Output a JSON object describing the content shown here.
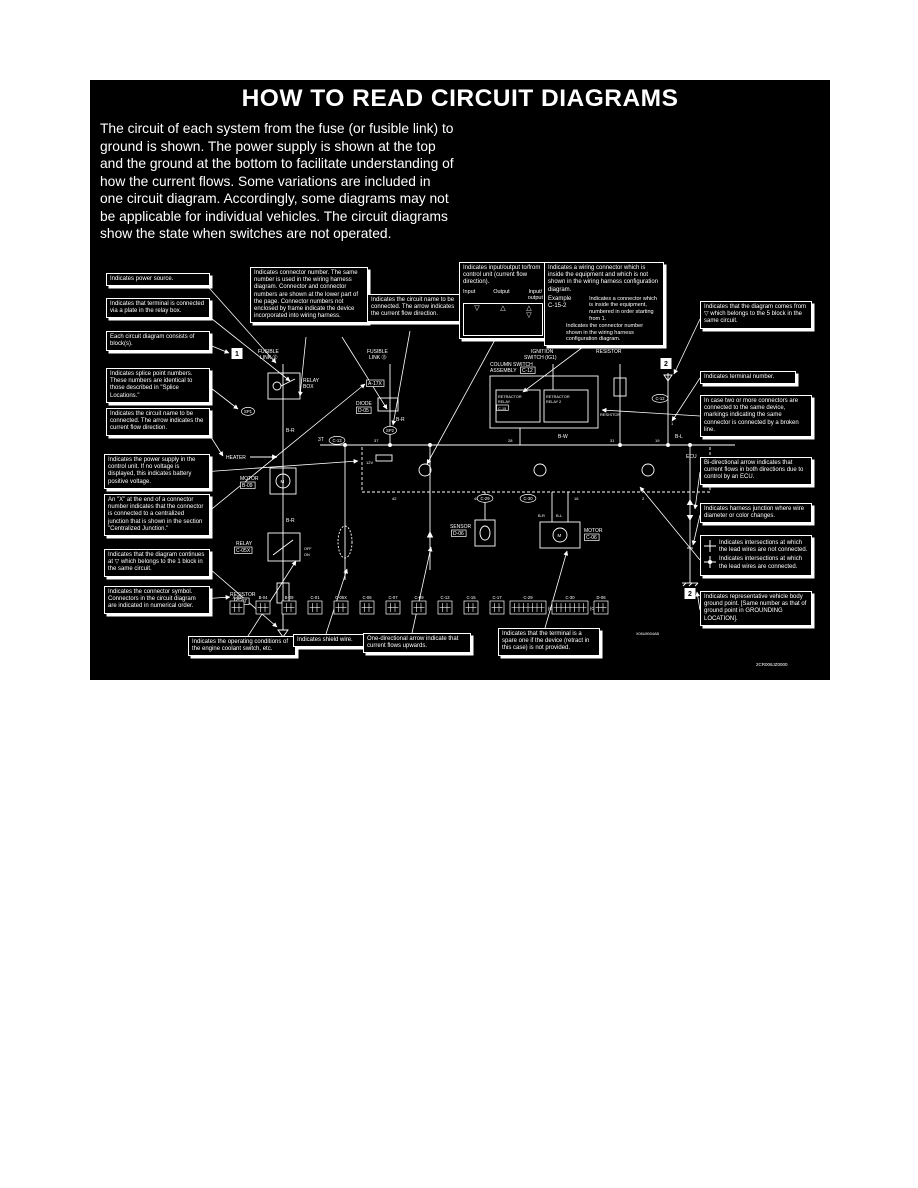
{
  "page": {
    "title": "HOW TO READ CIRCUIT DIAGRAMS"
  },
  "colors": {
    "background": "#ffffff",
    "panel": "#000000",
    "ink": "#ffffff"
  },
  "intro": {
    "text": "The circuit of each system from the fuse (or fusible link) to ground is shown. The power supply is shown at the top and the ground at the bottom to facilitate understanding of how the current flows. Some variations are included in one circuit diagram. Accordingly, some diagrams may not be applicable for individual vehicles. The circuit diagrams show the state when switches are not operated."
  },
  "callouts": {
    "left": [
      {
        "text": "Indicates power source."
      },
      {
        "text": "Indicates that terminal is connected via a plate in the relay box."
      },
      {
        "text": "Each circuit diagram consists of block(s)."
      },
      {
        "text": "Indicates splice point numbers. These numbers are identical to those described in \"Splice Locations.\""
      },
      {
        "text": "Indicates the circuit name to be connected. The arrow indicates the current flow direction."
      },
      {
        "text": "Indicates the power supply in the control unit. If no voltage is displayed, this indicates battery positive voltage."
      },
      {
        "text": "An \"X\" at the end of a connector number indicates that the connector is connected to a centralized junction that is shown in the section \"Centralized Junction.\""
      },
      {
        "text": "Indicates that the diagram continues at ▽ which belongs to the 1 block in the same circuit."
      },
      {
        "text": "Indicates the connector symbol. Connectors in the circuit diagram are indicated in numerical order."
      }
    ],
    "top": [
      {
        "text": "Indicates connector number. The same number is used in the wiring harness diagram. Connector and connector numbers are shown at the lower part of the page. Connector numbers not enclosed by frame indicate the device incorporated into wiring harness."
      },
      {
        "text": "Indicates the circuit name to be connected. The arrow indicates the current flow direction."
      }
    ],
    "io": {
      "caption": "Indicates input/output to/from control unit (current flow direction).",
      "input": "Input",
      "output": "Output",
      "io": "Input/\noutput",
      "input_symbol": "▽",
      "output_symbol": "△",
      "io_symbol": "△\n▽"
    },
    "wiring_connector": {
      "text": "Indicates a wiring connector which is inside the equipment and which is not shown in the wiring harness configuration diagram.",
      "example_label": "Example",
      "example_value": "C-15-2",
      "note_equipment": "Indicates a connector which is inside the equipment, numbered in order starting from 1.",
      "note_number": "Indicates the connector number shown in the wiring harness configuration diagram."
    },
    "right": [
      {
        "text": "Indicates that the diagram comes from ▽ which belongs to the 5 block in the same circuit."
      },
      {
        "text": "Indicates terminal number."
      },
      {
        "text": "In case two or more connectors are connected to the same device, markings indicating the same connector is connected by a broken line."
      },
      {
        "text": "Bi-directional arrow indicates that current flows in both directions due to control by an ECU."
      },
      {
        "text": "Indicates harness junction where wire diameter or color changes."
      },
      {
        "text": "Indicates representative vehicle body ground point. [Same number as that of ground point in GROUNDING LOCATION]."
      }
    ],
    "intersections": {
      "not_connected": "Indicates intersections at which the lead wires are not connected.",
      "connected": "Indicates intersections at which the lead wires are connected."
    },
    "bottom": [
      {
        "text": "Indicates the operating conditions of the engine coolant switch, etc."
      },
      {
        "text": "Indicates shield wire."
      },
      {
        "text": "One-directional arrow indicate that current flows upwards."
      },
      {
        "text": "Indicates that the terminal is a spare one if the device (retract in this case) is not provided."
      }
    ]
  },
  "diagram": {
    "codes": {
      "small": "X06U8004AB",
      "figure": "2CR006JZ0000"
    },
    "labels": [
      {
        "t": "FUSIBLE",
        "x": 168,
        "y": 273
      },
      {
        "t": "LINK ⑫",
        "x": 170,
        "y": 279
      },
      {
        "t": "FUSIBLE",
        "x": 277,
        "y": 273
      },
      {
        "t": "LINK ⑬",
        "x": 279,
        "y": 279
      },
      {
        "t": "IGNITION",
        "x": 441,
        "y": 273
      },
      {
        "t": "SWITCH (IG1)",
        "x": 434,
        "y": 279
      },
      {
        "t": "RESISTOR",
        "x": 506,
        "y": 273
      },
      {
        "t": "1",
        "x": 147,
        "y": 277,
        "wbox": true
      },
      {
        "t": "2",
        "x": 576,
        "y": 287,
        "wbox": true
      },
      {
        "t": "RELAY",
        "x": 213,
        "y": 302
      },
      {
        "t": "BOX",
        "x": 213,
        "y": 308
      },
      {
        "t": "SP1",
        "x": 158,
        "y": 333,
        "oval": true
      },
      {
        "t": "A-17X",
        "x": 278,
        "y": 305,
        "box": true
      },
      {
        "t": "DIODE",
        "x": 266,
        "y": 325
      },
      {
        "t": "D-05",
        "x": 268,
        "y": 332,
        "box": true
      },
      {
        "t": "B-R",
        "x": 196,
        "y": 352
      },
      {
        "t": "B-R",
        "x": 306,
        "y": 341
      },
      {
        "t": "B-R",
        "x": 196,
        "y": 442
      },
      {
        "t": "B-W",
        "x": 468,
        "y": 358
      },
      {
        "t": "B-L",
        "x": 585,
        "y": 358
      },
      {
        "t": "SP2",
        "x": 300,
        "y": 352,
        "oval": true
      },
      {
        "t": "HEATER",
        "x": 136,
        "y": 379
      },
      {
        "t": "MOTOR",
        "x": 150,
        "y": 400
      },
      {
        "t": "B-09",
        "x": 152,
        "y": 407,
        "box": true
      },
      {
        "t": "M",
        "x": 190.5,
        "y": 403,
        "s": 4.5
      },
      {
        "t": "COLUMN SWITCH",
        "x": 400,
        "y": 286
      },
      {
        "t": "ASSEMBLY",
        "x": 400,
        "y": 292
      },
      {
        "t": "C-12",
        "x": 432,
        "y": 292,
        "box": true
      },
      {
        "t": "RETRACTOR",
        "x": 408,
        "y": 318,
        "s": 3.8
      },
      {
        "t": "RELAY",
        "x": 408,
        "y": 323,
        "s": 3.8
      },
      {
        "t": "C-15",
        "x": 408,
        "y": 330,
        "s": 3.8,
        "box": true
      },
      {
        "t": "RETRACTOR",
        "x": 456,
        "y": 318,
        "s": 3.8
      },
      {
        "t": "RELAY 2",
        "x": 456,
        "y": 323,
        "s": 3.8
      },
      {
        "t": "RESISTOR",
        "x": 510,
        "y": 336,
        "s": 4
      },
      {
        "t": "C-12",
        "x": 570,
        "y": 320,
        "oval": true
      },
      {
        "t": "1",
        "x": 581,
        "y": 345,
        "s": 4
      },
      {
        "t": "3T",
        "x": 228,
        "y": 361
      },
      {
        "t": "C-13",
        "x": 247,
        "y": 362,
        "oval": true
      },
      {
        "t": "37",
        "x": 284,
        "y": 362,
        "s": 4
      },
      {
        "t": "28",
        "x": 418,
        "y": 362,
        "s": 4
      },
      {
        "t": "31",
        "x": 520,
        "y": 362,
        "s": 4
      },
      {
        "t": "19",
        "x": 565,
        "y": 362,
        "s": 4
      },
      {
        "t": "ECU",
        "x": 596,
        "y": 378
      },
      {
        "t": "12V",
        "x": 276,
        "y": 384,
        "s": 4
      },
      {
        "t": "42",
        "x": 302,
        "y": 420,
        "s": 4
      },
      {
        "t": "49",
        "x": 384,
        "y": 420,
        "s": 4
      },
      {
        "t": "16",
        "x": 484,
        "y": 420,
        "s": 4
      },
      {
        "t": "2",
        "x": 552,
        "y": 420,
        "s": 4
      },
      {
        "t": "C-29",
        "x": 395,
        "y": 420,
        "oval": true
      },
      {
        "t": "C-30",
        "x": 438,
        "y": 420,
        "oval": true
      },
      {
        "t": "SENSOR",
        "x": 360,
        "y": 448
      },
      {
        "t": "D-06",
        "x": 363,
        "y": 455,
        "box": true
      },
      {
        "t": "MOTOR",
        "x": 494,
        "y": 452
      },
      {
        "t": "C-06",
        "x": 496,
        "y": 459,
        "box": true
      },
      {
        "t": "M",
        "x": 467.5,
        "y": 457,
        "s": 4.5
      },
      {
        "t": "B-R",
        "x": 448,
        "y": 437,
        "s": 4
      },
      {
        "t": "B-L",
        "x": 466,
        "y": 437,
        "s": 4
      },
      {
        "t": "RELAY",
        "x": 146,
        "y": 465
      },
      {
        "t": "C-05X",
        "x": 146,
        "y": 472,
        "box": true
      },
      {
        "t": "OFF",
        "x": 214,
        "y": 470,
        "s": 3.8
      },
      {
        "t": "ON",
        "x": 214,
        "y": 476,
        "s": 3.8
      },
      {
        "t": "RESISTOR",
        "x": 140,
        "y": 516
      },
      {
        "t": "C-07",
        "x": 146,
        "y": 523,
        "box": true
      },
      {
        "t": "2",
        "x": 600,
        "y": 517,
        "wbox": true
      },
      {
        "t": "X06U8004AB",
        "x": 546,
        "y": 555,
        "s": 3.8
      },
      {
        "t": "2CR006JZ0000",
        "x": 666,
        "y": 586,
        "s": 4.5
      }
    ],
    "connectors": [
      {
        "label": "A-02",
        "x": 140,
        "w": 14
      },
      {
        "label": "B-04",
        "x": 166,
        "w": 14
      },
      {
        "label": "B-09",
        "x": 192,
        "w": 14
      },
      {
        "label": "C-01",
        "x": 218,
        "w": 14
      },
      {
        "label": "C-05X",
        "x": 244,
        "w": 14
      },
      {
        "label": "C-06",
        "x": 270,
        "w": 14
      },
      {
        "label": "C-07",
        "x": 296,
        "w": 14
      },
      {
        "label": "C-09",
        "x": 322,
        "w": 14
      },
      {
        "label": "C-12",
        "x": 348,
        "w": 14
      },
      {
        "label": "C-15",
        "x": 374,
        "w": 14
      },
      {
        "label": "C-17",
        "x": 400,
        "w": 14
      },
      {
        "label": "C-29",
        "x": 420,
        "w": 36,
        "note": "(GRAY)"
      },
      {
        "label": "C-30",
        "x": 462,
        "w": 36,
        "note": "(GRAY)"
      },
      {
        "label": "D-06",
        "x": 504,
        "w": 14
      }
    ]
  }
}
